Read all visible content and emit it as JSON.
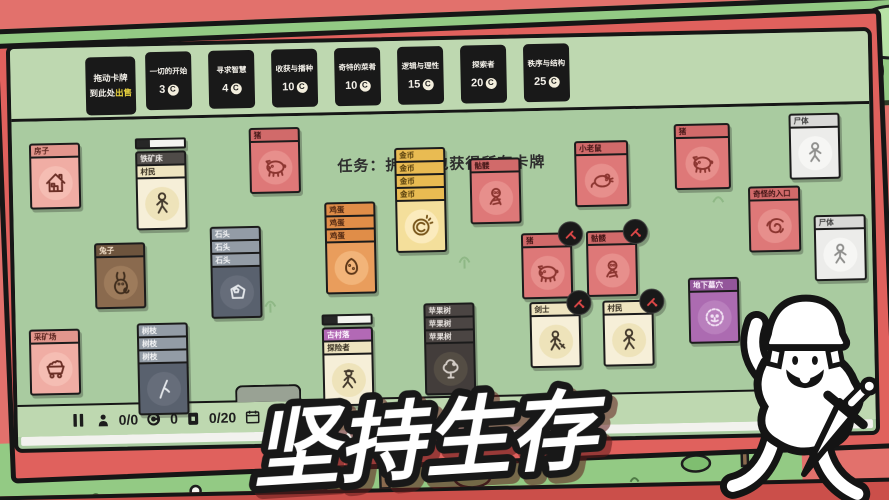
{
  "headline": "坚持生存",
  "coin_symbol": "C",
  "top_bar": {
    "sell_slot": {
      "line1": "拖动卡牌",
      "line2_prefix": "到此处",
      "line2_highlight": "出售",
      "highlight_color": "#e8d23e"
    },
    "packs": [
      {
        "label": "一切的开始",
        "cost": "3"
      },
      {
        "label": "寻求智慧",
        "cost": "4"
      },
      {
        "label": "收获与播种",
        "cost": "10"
      },
      {
        "label": "奇特的菜肴",
        "cost": "10"
      },
      {
        "label": "逻辑与理性",
        "cost": "15"
      },
      {
        "label": "探索者",
        "cost": "20"
      },
      {
        "label": "秩序与结构",
        "cost": "25"
      }
    ]
  },
  "board": {
    "quest_text": "任务：拆开卡包获得所有卡牌",
    "cards": [
      {
        "id": "house",
        "x": 17,
        "y": 95,
        "rows": [
          {
            "label": "房子",
            "pal": "salmon"
          }
        ],
        "body": {
          "pal": "salmon",
          "icon": "house-icon"
        }
      },
      {
        "id": "iron-deposit",
        "x": 123,
        "y": 92,
        "progress": 0.28,
        "rows": [
          {
            "label": "铁矿床",
            "pal": "dark"
          },
          {
            "label": "村民",
            "pal": "cream"
          }
        ],
        "body": {
          "pal": "cream",
          "icon": "villager-icon"
        }
      },
      {
        "id": "rabbit",
        "x": 80,
        "y": 196,
        "rows": [
          {
            "label": "兔子",
            "pal": "brown"
          }
        ],
        "body": {
          "pal": "brown",
          "icon": "rabbit-icon"
        }
      },
      {
        "id": "stone-stack",
        "x": 196,
        "y": 182,
        "rows": [
          {
            "label": "石头",
            "pal": "stoneh"
          },
          {
            "label": "石头",
            "pal": "stoneh"
          },
          {
            "label": "石头",
            "pal": "stoneh"
          }
        ],
        "body": {
          "pal": "stone",
          "icon": "stone-icon"
        }
      },
      {
        "id": "branch-stack",
        "x": 121,
        "y": 277,
        "rows": [
          {
            "label": "树枝",
            "pal": "stoneh"
          },
          {
            "label": "树枝",
            "pal": "stoneh"
          },
          {
            "label": "树枝",
            "pal": "stoneh"
          }
        ],
        "body": {
          "pal": "stone",
          "icon": "branch-icon"
        }
      },
      {
        "id": "mine",
        "x": 13,
        "y": 281,
        "rows": [
          {
            "label": "采矿场",
            "pal": "salmon"
          }
        ],
        "body": {
          "pal": "salmon",
          "icon": "minecart-icon"
        }
      },
      {
        "id": "pig-1",
        "x": 237,
        "y": 84,
        "rows": [
          {
            "label": "猪",
            "pal": "red"
          }
        ],
        "body": {
          "pal": "red",
          "icon": "pig-icon"
        }
      },
      {
        "id": "egg-stack",
        "x": 311,
        "y": 160,
        "rows": [
          {
            "label": "鸡蛋",
            "pal": "eggh"
          },
          {
            "label": "鸡蛋",
            "pal": "eggh"
          },
          {
            "label": "鸡蛋",
            "pal": "eggh"
          }
        ],
        "body": {
          "pal": "egg",
          "icon": "egg-icon"
        }
      },
      {
        "id": "coin-stack",
        "x": 382,
        "y": 107,
        "rows": [
          {
            "label": "金币",
            "pal": "goldh"
          },
          {
            "label": "金币",
            "pal": "goldh"
          },
          {
            "label": "金币",
            "pal": "goldh"
          },
          {
            "label": "金币",
            "pal": "goldh"
          }
        ],
        "body": {
          "pal": "gold",
          "icon": "coin-icon"
        }
      },
      {
        "id": "skeleton-1",
        "x": 457,
        "y": 119,
        "rows": [
          {
            "label": "骷髅",
            "pal": "red"
          }
        ],
        "body": {
          "pal": "red",
          "icon": "skeleton-icon"
        }
      },
      {
        "id": "rat",
        "x": 562,
        "y": 104,
        "w": 54,
        "rows": [
          {
            "label": "小老鼠",
            "pal": "red"
          }
        ],
        "body": {
          "pal": "red",
          "icon": "rat-icon"
        }
      },
      {
        "id": "pig-2",
        "x": 507,
        "y": 195,
        "badge": true,
        "rows": [
          {
            "label": "猪",
            "pal": "red"
          }
        ],
        "body": {
          "pal": "red",
          "icon": "pig-icon"
        }
      },
      {
        "id": "skeleton-2",
        "x": 572,
        "y": 194,
        "badge": true,
        "rows": [
          {
            "label": "骷髅",
            "pal": "red"
          }
        ],
        "body": {
          "pal": "red",
          "icon": "skeleton-icon"
        }
      },
      {
        "id": "swordsman",
        "x": 514,
        "y": 264,
        "badge": true,
        "rows": [
          {
            "label": "剑士",
            "pal": "cream"
          }
        ],
        "body": {
          "pal": "cream",
          "icon": "swordsman-icon"
        }
      },
      {
        "id": "villager-2",
        "x": 587,
        "y": 264,
        "badge": true,
        "rows": [
          {
            "label": "村民",
            "pal": "cream"
          }
        ],
        "body": {
          "pal": "cream",
          "icon": "villager-icon"
        }
      },
      {
        "id": "old-village",
        "x": 306,
        "y": 272,
        "progress": 0.3,
        "rows": [
          {
            "label": "古村落",
            "pal": "purple"
          },
          {
            "label": "探险者",
            "pal": "cream"
          }
        ],
        "body": {
          "pal": "cream",
          "icon": "explorer-icon"
        }
      },
      {
        "id": "apple-tree-stack",
        "x": 408,
        "y": 263,
        "rows": [
          {
            "label": "苹果树",
            "pal": "darkh"
          },
          {
            "label": "苹果树",
            "pal": "darkh"
          },
          {
            "label": "苹果树",
            "pal": "darkh"
          }
        ],
        "body": {
          "pal": "darkb",
          "icon": "apple-tree-icon"
        }
      },
      {
        "id": "pig-3",
        "x": 662,
        "y": 89,
        "w": 56,
        "rows": [
          {
            "label": "猪",
            "pal": "red"
          }
        ],
        "body": {
          "pal": "red",
          "icon": "pig-icon"
        }
      },
      {
        "id": "corpse-1",
        "x": 777,
        "y": 81,
        "rows": [
          {
            "label": "尸体",
            "pal": "white"
          }
        ],
        "body": {
          "pal": "white",
          "icon": "corpse-icon"
        }
      },
      {
        "id": "strange-portal",
        "x": 735,
        "y": 153,
        "w": 52,
        "rows": [
          {
            "label": "奇怪的入口",
            "pal": "red"
          }
        ],
        "body": {
          "pal": "red",
          "icon": "portal-icon"
        }
      },
      {
        "id": "corpse-2",
        "x": 800,
        "y": 183,
        "w": 52,
        "rows": [
          {
            "label": "尸体",
            "pal": "white"
          }
        ],
        "body": {
          "pal": "white",
          "icon": "corpse-icon"
        }
      },
      {
        "id": "catacombs",
        "x": 673,
        "y": 243,
        "rows": [
          {
            "label": "地下墓穴",
            "pal": "violet"
          }
        ],
        "body": {
          "pal": "violet",
          "icon": "catacombs-icon"
        }
      }
    ]
  },
  "status_bar": {
    "workers": "0/0",
    "coins": "0",
    "card_count": "0/20",
    "day": "第1天"
  },
  "palettes": {
    "salmon": {
      "header": "#e2968d",
      "body": "#f0ada4",
      "text": "#59241e",
      "icon": "#6b2f26",
      "glow": "#f6c0b6"
    },
    "red": {
      "header": "#d16a6a",
      "body": "#de7878",
      "text": "#401414",
      "icon": "#8c3530",
      "glow": "#e9938f"
    },
    "cream": {
      "header": "#eee4c0",
      "body": "#f6efd8",
      "text": "#322a1d",
      "icon": "#43392c",
      "glow": "#ece0b5"
    },
    "brown": {
      "header": "#6d543d",
      "body": "#8a6a4e",
      "text": "#f2dfc9",
      "icon": "#3f2d1d",
      "glow": "#a07e5e"
    },
    "stoneh": {
      "header": "#939ca6",
      "text": "#f4f5f6"
    },
    "stone": {
      "body": "#59616e",
      "icon": "#e3e6ea",
      "glow": "#68707d"
    },
    "eggh": {
      "header": "#e08d48",
      "text": "#4b2410"
    },
    "egg": {
      "body": "#e99d5c",
      "icon": "#5e3718",
      "glow": "#f3b97e"
    },
    "goldh": {
      "header": "#e9bb52",
      "text": "#50390a"
    },
    "gold": {
      "body": "#f4df9b",
      "icon": "#77551a",
      "glow": "#fbedc3"
    },
    "purple": {
      "header": "#b269b5",
      "text": "#fdf4fe"
    },
    "violet": {
      "header": "#93569a",
      "body": "#ac6bb1",
      "text": "#fceffd",
      "icon": "#f3e3f5",
      "glow": "#bb82c0"
    },
    "darkh": {
      "header": "#4b4543",
      "text": "#eae5e1"
    },
    "darkb": {
      "body": "#433d3b",
      "icon": "#d3ccc6",
      "glow": "#575047"
    },
    "white": {
      "header": "#d9d9d7",
      "body": "#ececea",
      "text": "#3c3c3c",
      "icon": "#8e8e8c",
      "glow": "#f8f8f6"
    },
    "dark": {
      "header": "#4f4b48",
      "text": "#f1ede9"
    },
    "badge_red": "#e04848"
  }
}
